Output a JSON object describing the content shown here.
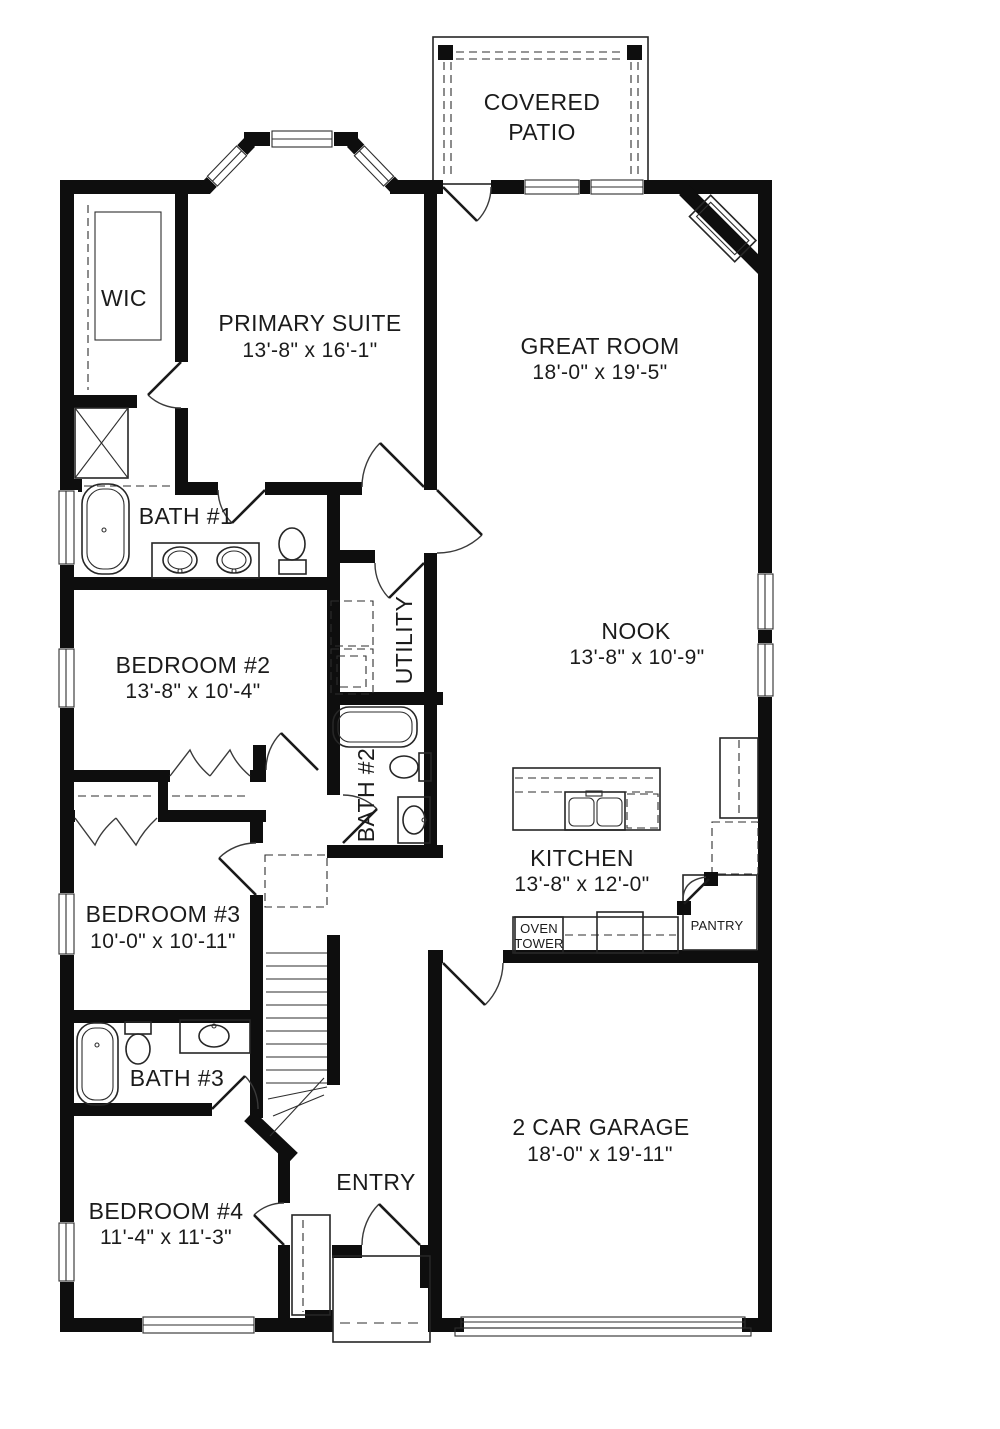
{
  "plan": {
    "type": "single-story-floor-plan",
    "colors": {
      "wall": "#0e0e0e",
      "background": "#ffffff",
      "line": "#262626",
      "text": "#1b1b1b"
    },
    "rooms": {
      "covered_patio": {
        "line1": "COVERED",
        "line2": "PATIO"
      },
      "wic": {
        "name": "WIC"
      },
      "primary_suite": {
        "name": "PRIMARY SUITE",
        "dims": "13'-8\" x 16'-1\""
      },
      "great_room": {
        "name": "GREAT ROOM",
        "dims": "18'-0\" x 19'-5\""
      },
      "bath_1": {
        "name": "BATH #1"
      },
      "utility": {
        "name": "UTILITY"
      },
      "nook": {
        "name": "NOOK",
        "dims": "13'-8\" x 10'-9\""
      },
      "bedroom_2": {
        "name": "BEDROOM #2",
        "dims": "13'-8\" x 10'-4\""
      },
      "bath_2": {
        "name": "BATH #2"
      },
      "kitchen": {
        "name": "KITCHEN",
        "dims": "13'-8\" x 12'-0\""
      },
      "oven_tower": {
        "line1": "OVEN",
        "line2": "TOWER"
      },
      "pantry": {
        "name": "PANTRY"
      },
      "bedroom_3": {
        "name": "BEDROOM #3",
        "dims": "10'-0\" x 10'-11\""
      },
      "bath_3": {
        "name": "BATH #3"
      },
      "bedroom_4": {
        "name": "BEDROOM #4",
        "dims": "11'-4\" x 11'-3\""
      },
      "entry": {
        "name": "ENTRY"
      },
      "garage": {
        "name": "2 CAR GARAGE",
        "dims": "18'-0\" x 19'-11\""
      }
    }
  }
}
